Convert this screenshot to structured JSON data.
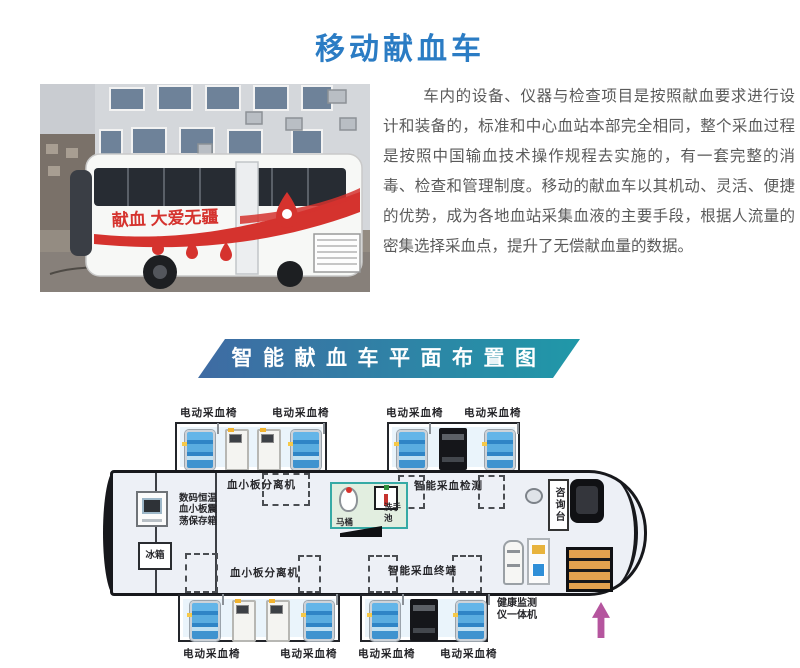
{
  "title": "移动献血车",
  "intro": "车内的设备、仪器与检查项目是按照献血要求进行设计和装备的，标准和中心血站本部完全相同，整个采血过程是按照中国输血技术操作规程去实施的，有一套完整的消毒、检查和管理制度。移动的献血车以其机动、灵活、便捷的优势，成为各地血站采集血液的主要手段，根据人流量的密集选择采血点，提升了无偿献血量的数据。",
  "photo": {
    "slogan": "献血 大爱无疆"
  },
  "banner": {
    "text": "智能献血车平面布置图",
    "gradient_left": "#3f6ba3",
    "gradient_right": "#2098a8"
  },
  "fp": {
    "top_labels": [
      "电动采血椅",
      "电动采血椅",
      "电动采血椅",
      "电动采血椅"
    ],
    "bottom_labels": [
      "电动采血椅",
      "电动采血椅",
      "电动采血椅",
      "电动采血椅"
    ],
    "platelet_top": "血小板分离机",
    "platelet_bottom": "血小板分离机",
    "storage_box": "数码恒温血小板震荡保存箱",
    "fridge": "冰箱",
    "toilet": "马桶",
    "sink": "洗手池",
    "smart_detect": "智能采血检测",
    "smart_terminal": "智能采血终端",
    "consult": "咨询台",
    "health_monitor": "健康监测仪一体机",
    "arrow_color": "#b5559e"
  }
}
